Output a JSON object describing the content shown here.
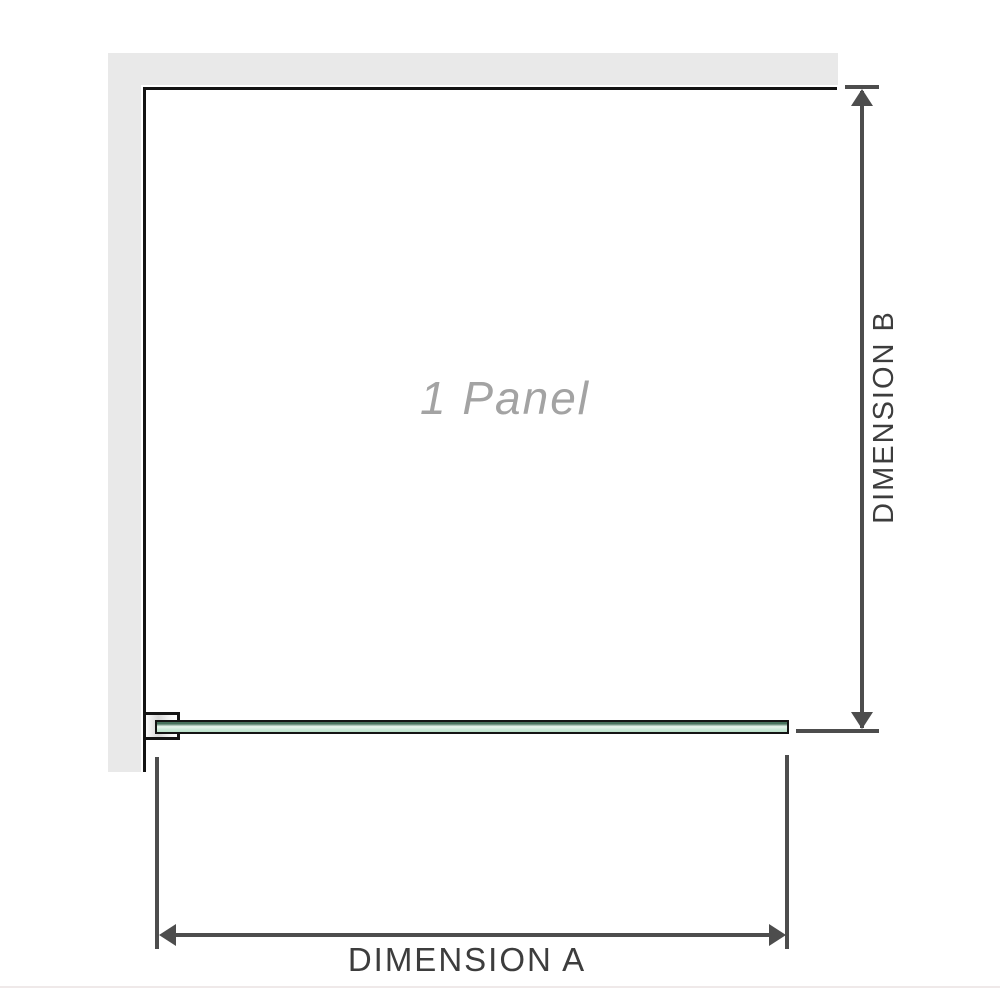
{
  "diagram": {
    "panel_label": "1 Panel",
    "dimension_a_label": "DIMENSION A",
    "dimension_b_label": "DIMENSION B",
    "icons": {
      "dimension_b_top": "arrow-up-icon",
      "dimension_b_bottom": "arrow-down-icon",
      "dimension_a_left": "arrow-left-icon",
      "dimension_a_right": "arrow-right-icon"
    },
    "colors": {
      "wall": "#e9e9e9",
      "outline": "#141414",
      "dim": "#4d4d4d",
      "label_text": "#3d3d3d",
      "watermark": "#a3a3a3",
      "glass_dark": "#47725d",
      "glass_highlight": "#eaf7ef",
      "glass_light": "#cdeada",
      "glass_shade": "#b9e0c9",
      "divider": "#efe9e9"
    }
  }
}
